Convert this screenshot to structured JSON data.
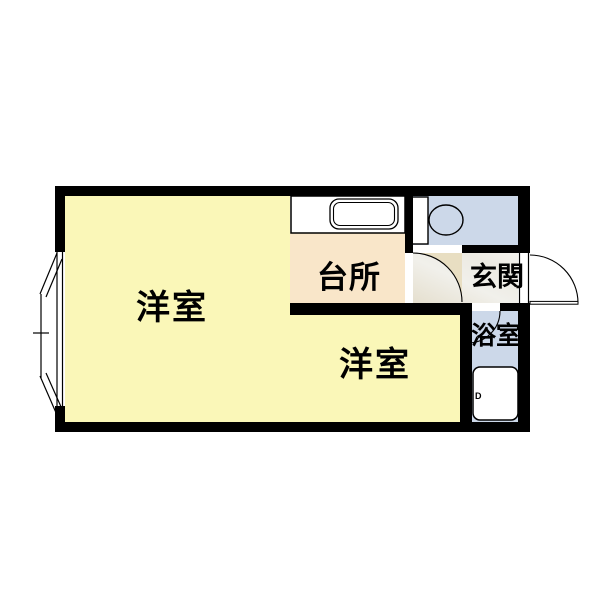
{
  "floorplan": {
    "rooms": {
      "main_room": {
        "label": "洋室"
      },
      "kitchen": {
        "label": "台所"
      },
      "entrance": {
        "label": "玄関"
      },
      "bathroom": {
        "label": "浴室"
      },
      "second_room": {
        "label": "洋室"
      }
    },
    "fixtures": {
      "sink": "kitchen-sink",
      "toilet": "toilet",
      "bathtub": "bathtub",
      "bay_window": "bay-window",
      "tub_mark": "D"
    },
    "doors": {
      "entrance_door": "entrance-door-swing-right",
      "toilet_door": "toilet-door-swing-out",
      "bathroom_door": "bathroom-door-swing-in"
    },
    "colors": {
      "wall": "#000000",
      "room_yellow": "#FAF7B8",
      "kitchen_peach": "#F9E6C9",
      "wet_area_blue": "#CCD8E9",
      "entrance_gray": "#EDECE5",
      "door_swing_beige": "#E8DEC2",
      "fixture_white": "#FFFFFF",
      "line": "#000000",
      "background": "#FFFFFF"
    }
  }
}
